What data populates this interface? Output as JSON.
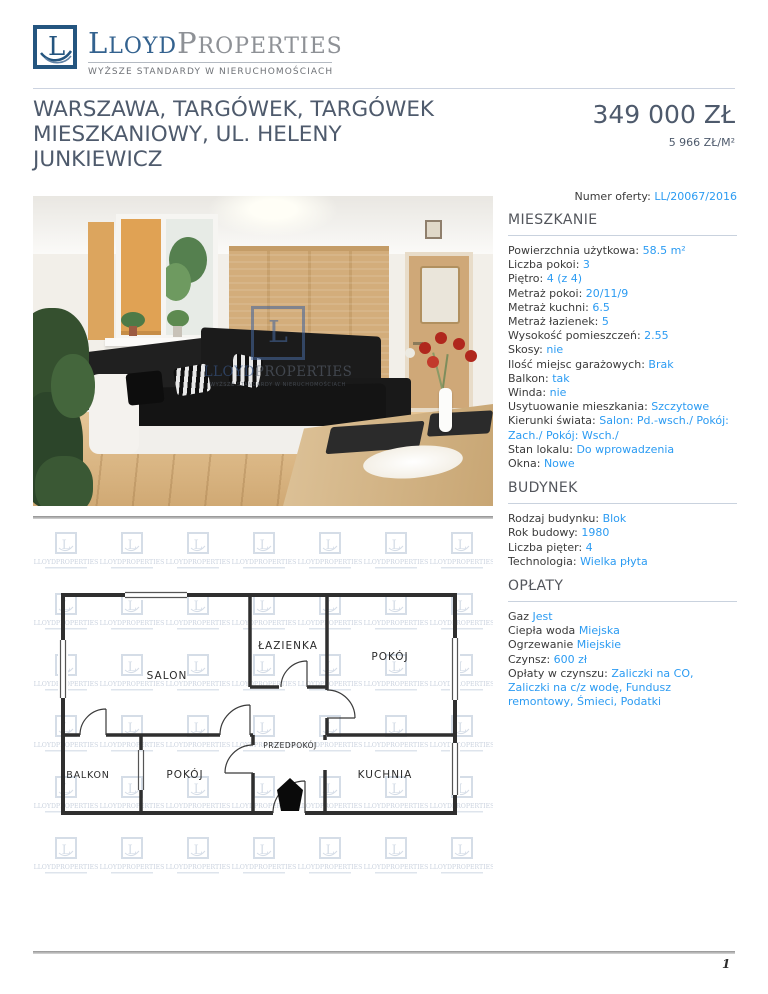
{
  "brand": {
    "initial1": "L",
    "rest1": "LOYD",
    "initial2": "P",
    "rest2": "ROPERTIES",
    "tagline": "WYŻSZE STANDARDY W NIERUCHOMOŚCIACH",
    "icon_letter": "L"
  },
  "listing": {
    "title": "WARSZAWA, TARGÓWEK, TARGÓWEK MIESZKANIOWY, UL. HELENY JUNKIEWICZ",
    "price": "349 000 ZŁ",
    "price_per_m2": "5 966 ZŁ/M²",
    "offer_label": "Numer oferty:",
    "offer_value": "LL/20067/2016"
  },
  "photo_watermark": {
    "square_letter": "L",
    "name_part1": "LLOYD",
    "name_part2": "PROPERTIES",
    "tagline": "WYŻSZE STANDARDY W NIERUCHOMOŚCIACH"
  },
  "sections": {
    "mieszkanie": {
      "title": "MIESZKANIE",
      "rows": [
        {
          "label": "Powierzchnia użytkowa:",
          "value": "58.5 m²"
        },
        {
          "label": "Liczba pokoi:",
          "value": "3"
        },
        {
          "label": "Piętro:",
          "value": "4 (z 4)"
        },
        {
          "label": "Metraż pokoi:",
          "value": "20/11/9"
        },
        {
          "label": "Metraż kuchni:",
          "value": "6.5"
        },
        {
          "label": "Metraż łazienek:",
          "value": "5"
        },
        {
          "label": "Wysokość pomieszczeń:",
          "value": "2.55"
        },
        {
          "label": "Skosy:",
          "value": "nie"
        },
        {
          "label": "Ilość miejsc garażowych:",
          "value": "Brak"
        },
        {
          "label": "Balkon:",
          "value": "tak"
        },
        {
          "label": "Winda:",
          "value": "nie"
        },
        {
          "label": "Usytuowanie mieszkania:",
          "value": "Szczytowe"
        },
        {
          "label": "Kierunki świata:",
          "value": "Salon: Pd.-wsch./ Pokój: Zach./ Pokój: Wsch./"
        },
        {
          "label": "Stan lokalu:",
          "value": "Do wprowadzenia"
        },
        {
          "label": "Okna:",
          "value": "Nowe"
        }
      ]
    },
    "budynek": {
      "title": "BUDYNEK",
      "rows": [
        {
          "label": "Rodzaj budynku:",
          "value": "Blok"
        },
        {
          "label": "Rok budowy:",
          "value": "1980"
        },
        {
          "label": "Liczba pięter:",
          "value": "4"
        },
        {
          "label": "Technologia:",
          "value": "Wielka płyta"
        }
      ]
    },
    "oplaty": {
      "title": "OPŁATY",
      "rows": [
        {
          "label": "Gaz",
          "value": "Jest"
        },
        {
          "label": "Ciepła woda",
          "value": "Miejska"
        },
        {
          "label": "Ogrzewanie",
          "value": "Miejskie"
        },
        {
          "label": "Czynsz:",
          "value": "600 zł"
        },
        {
          "label": "Opłaty w czynszu:",
          "value": "Zaliczki na CO, Zaliczki na c/z wodę, Fundusz remontowy, Śmieci, Podatki"
        }
      ]
    }
  },
  "floor_plan": {
    "rooms": {
      "salon": "SALON",
      "lazienka": "ŁAZIENKA",
      "pokoj_top": "POKÓJ",
      "przedpokoj": "PRZEDPOKÓJ",
      "balkon": "BALKON",
      "pokoj_bottom": "POKÓJ",
      "kuchnia": "KUCHNIA"
    },
    "watermark_text": "LLOYDPROPERTIES"
  },
  "footer": {
    "page_number": "1"
  },
  "colors": {
    "accent_value_blue": "#2b9bf2",
    "title_slate": "#4e5a6c",
    "logo_blue": "#33628f",
    "logo_gray": "#8e9196",
    "section_underline": "#c9d2de"
  }
}
